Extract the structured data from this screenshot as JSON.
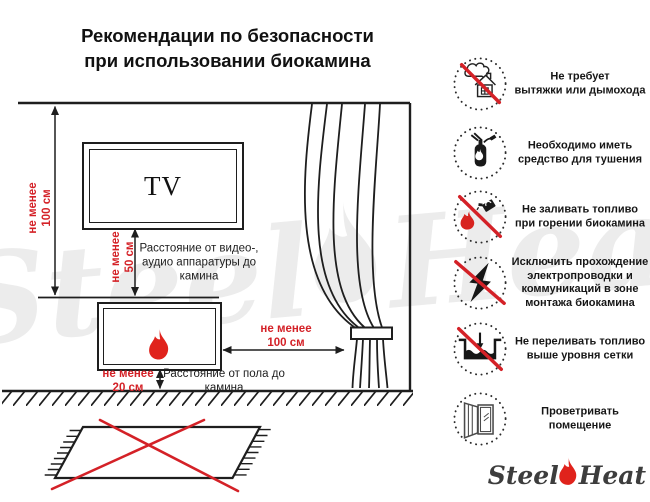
{
  "title": "Рекомендации по безопасности\nпри использовании биокамина",
  "diagram": {
    "tv_label": "TV",
    "wall_height_label": "не менее\n100 см",
    "tv_gap_label": "не менее\n50 см",
    "tv_gap_caption": "Расстояние от видео-,\nаудио аппаратуры до\nкамина",
    "floor_gap_label": "не менее\n20 см",
    "floor_gap_caption": "Расстояние от пола до\nкамина",
    "curtain_gap_label": "не менее\n100 см"
  },
  "rules": [
    {
      "icon": "no-chimney-icon",
      "crossed": true,
      "text": "Не требует\nвытяжки или дымохода"
    },
    {
      "icon": "extinguisher-icon",
      "crossed": false,
      "text": "Необходимо иметь\nсредство для тушения"
    },
    {
      "icon": "no-refuel-while-burning-icon",
      "crossed": true,
      "text": "Не заливать топливо\nпри горении биокамина"
    },
    {
      "icon": "no-wiring-icon",
      "crossed": true,
      "text": "Исключить прохождение\nэлектропроводки и\nкоммуникаций в зоне\nмонтажа биокамина"
    },
    {
      "icon": "no-overfill-icon",
      "crossed": true,
      "text": "Не переливать топливо\nвыше уровня сетки"
    },
    {
      "icon": "ventilate-icon",
      "crossed": false,
      "text": "Проветривать\nпомещение"
    }
  ],
  "brand": {
    "steel": "Steel",
    "heat": "Heat"
  },
  "colors": {
    "accent_red": "#d42127",
    "ink": "#1e1e1e",
    "watermark_gray": "#ececec"
  }
}
